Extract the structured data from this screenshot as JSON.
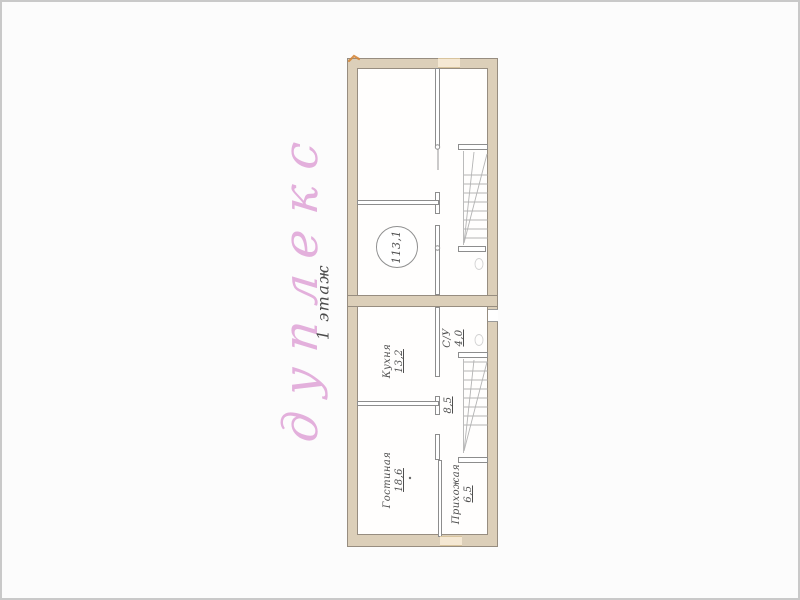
{
  "title": {
    "text": "дуплекс",
    "color": "#dc9bd4"
  },
  "floor_label": {
    "text": "1 этаж",
    "color": "#4b4b4b"
  },
  "total_area": {
    "value": "113,1"
  },
  "rooms": {
    "kitchen": {
      "name": "Кухня",
      "area": "13,2"
    },
    "bathroom": {
      "name": "С/У",
      "area": "4,0"
    },
    "hallway": {
      "area": "8,5"
    },
    "living": {
      "name": "Гостиная",
      "area": "18,6"
    },
    "entry": {
      "name": "Прихожая",
      "area": "6,5"
    }
  },
  "colors": {
    "wall_fill": "#dccfb9",
    "wall_outline": "#978d80",
    "partition_line": "#8d8d8d",
    "opening_fill": "#f5e8d3",
    "stair_line": "#b4b4b4",
    "label_text": "#4f4f4f",
    "scan_border": "#c9c9c9"
  }
}
